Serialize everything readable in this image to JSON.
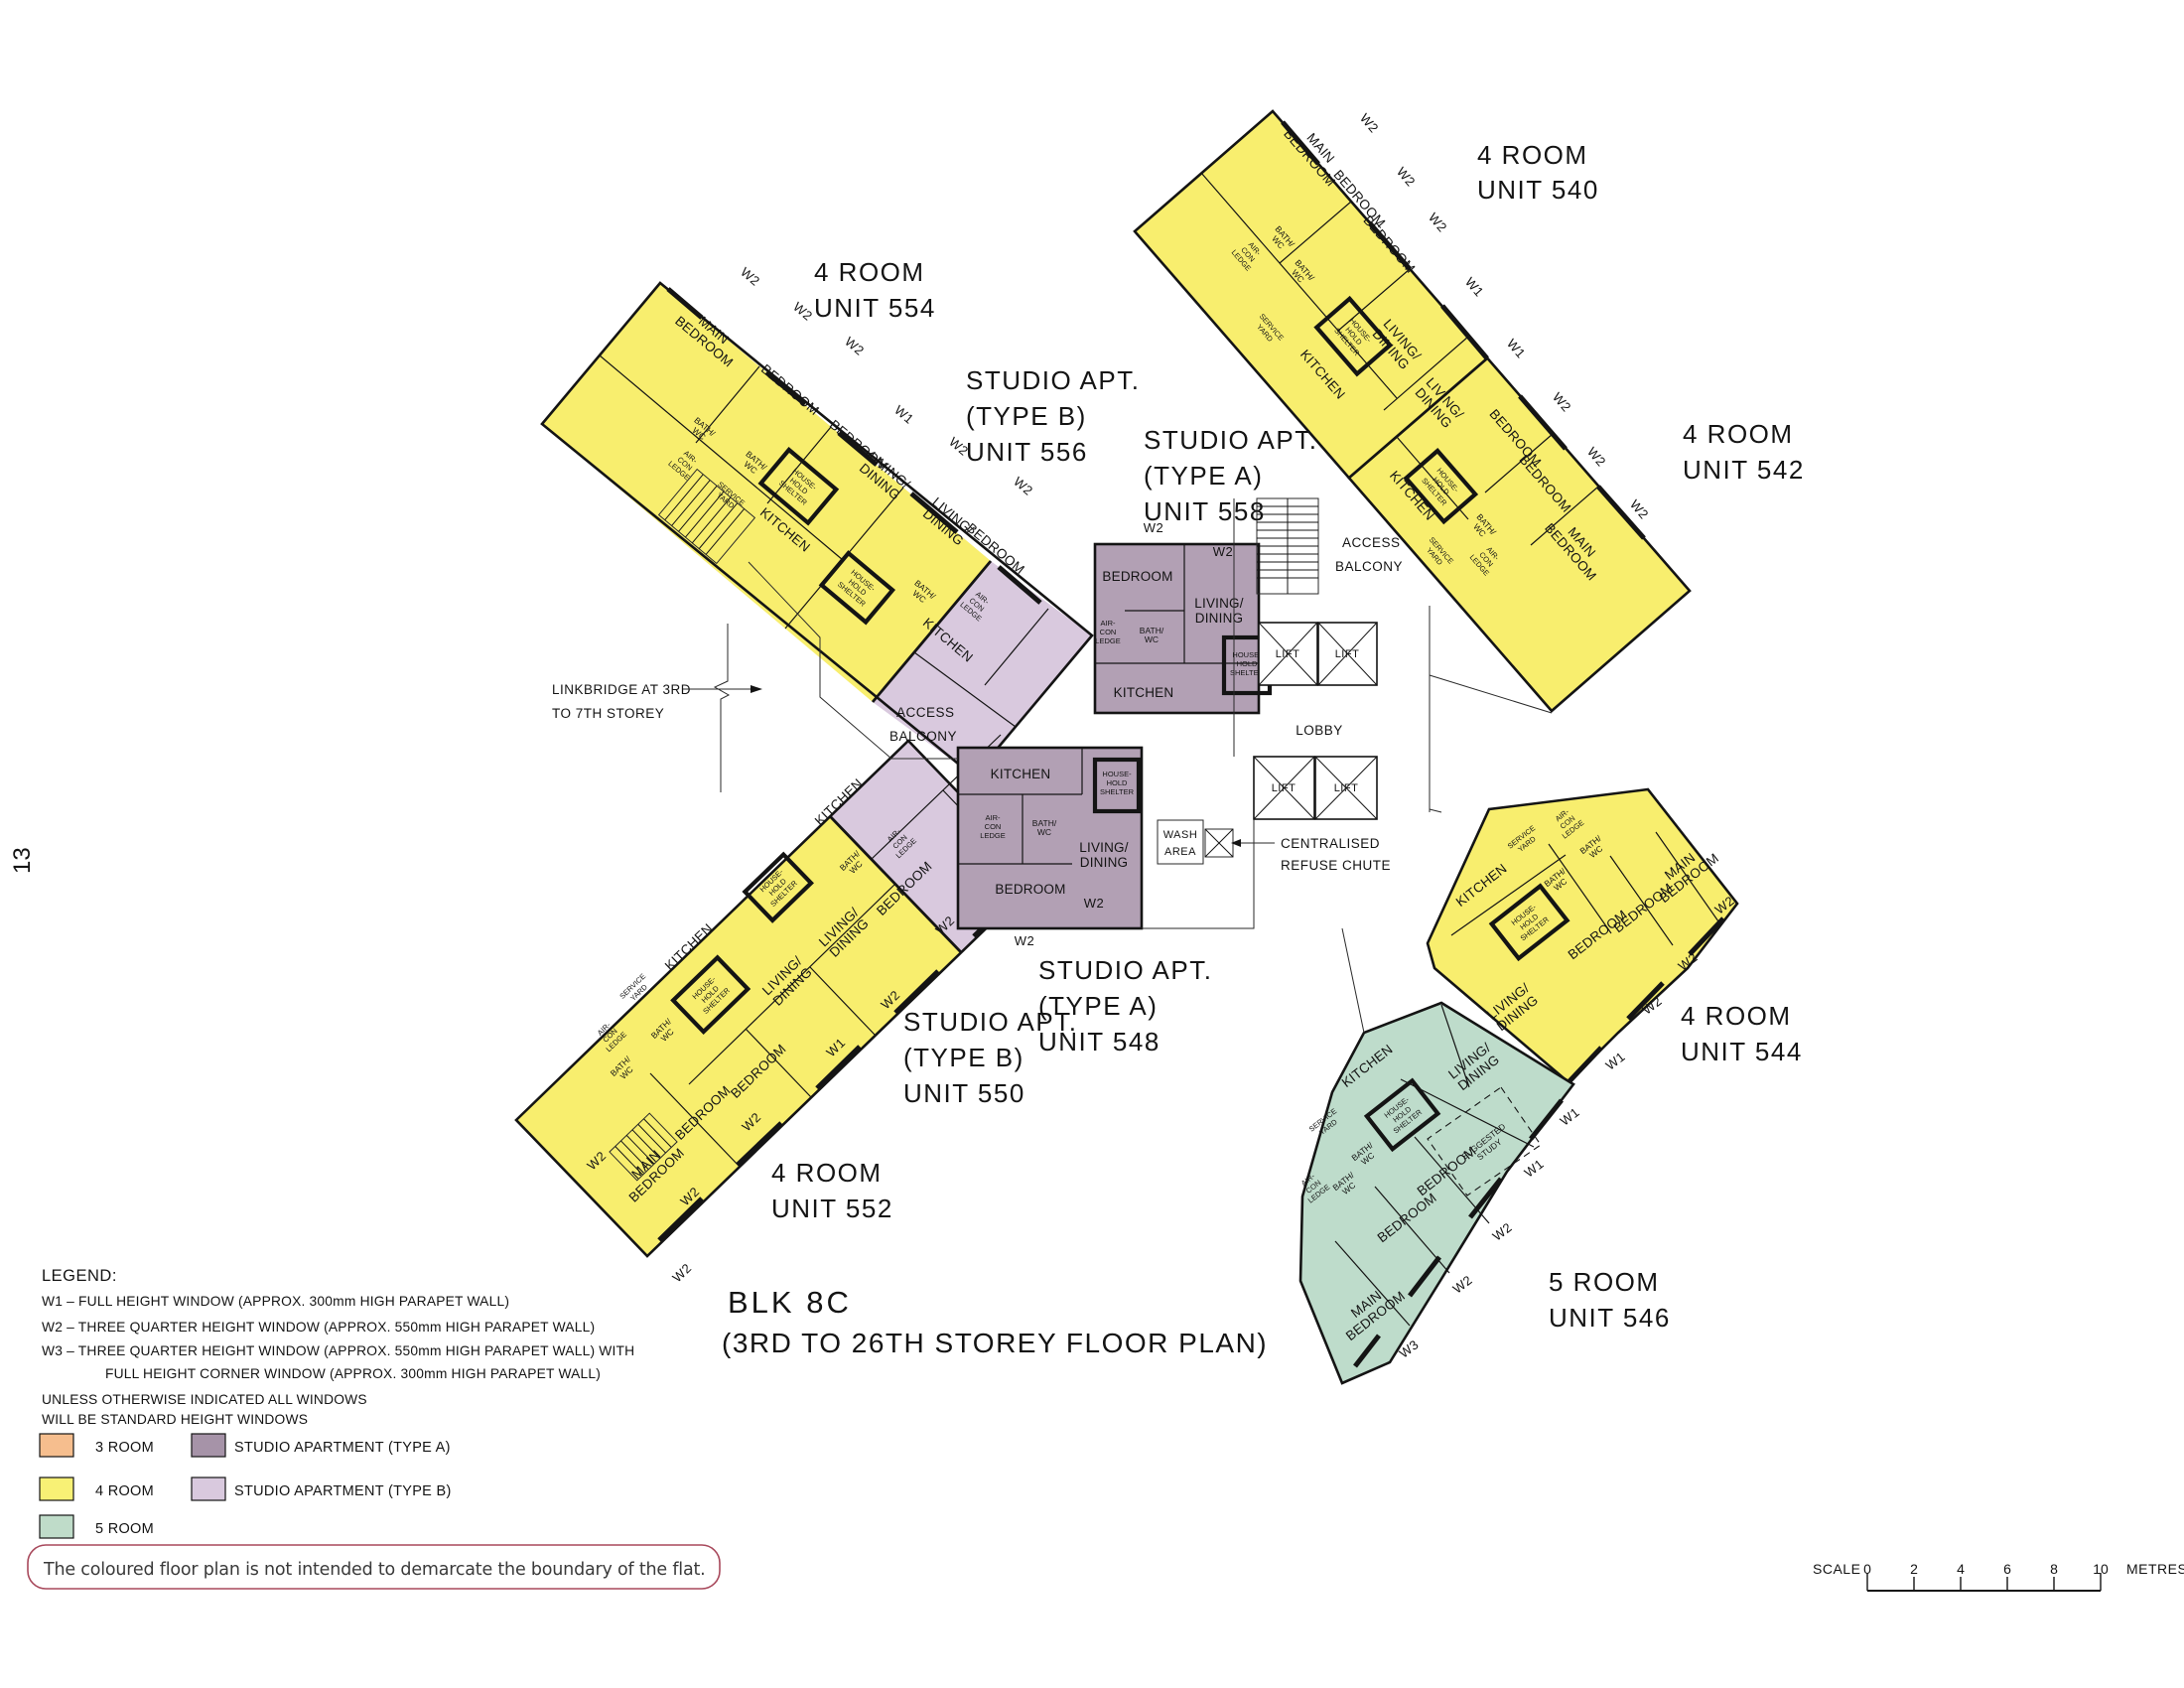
{
  "page": {
    "number": "13"
  },
  "title": {
    "l1": "BLK 8C",
    "l2": "(3RD TO 26TH STOREY FLOOR PLAN)"
  },
  "scale": {
    "label": "SCALE",
    "unit": "METRES",
    "t": [
      "0",
      "2",
      "4",
      "6",
      "8",
      "10"
    ]
  },
  "legend": {
    "heading": "LEGEND:",
    "w1": "W1 –  FULL HEIGHT WINDOW (APPROX. 300mm HIGH PARAPET WALL)",
    "w2": "W2 –  THREE QUARTER HEIGHT WINDOW (APPROX. 550mm HIGH PARAPET WALL)",
    "w3a": "W3 –  THREE QUARTER HEIGHT WINDOW (APPROX. 550mm HIGH PARAPET WALL) WITH",
    "w3b": "FULL HEIGHT CORNER WINDOW (APPROX. 300mm HIGH PARAPET WALL)",
    "note1": "UNLESS OTHERWISE INDICATED ALL WINDOWS",
    "note2": "WILL BE STANDARD HEIGHT WINDOWS",
    "swatches": [
      {
        "label": "3 ROOM",
        "color": "#F6BE8E"
      },
      {
        "label": "4 ROOM",
        "color": "#F8F175"
      },
      {
        "label": "5 ROOM",
        "color": "#BFDCC9"
      },
      {
        "label": "STUDIO APARTMENT (TYPE A)",
        "color": "#A693A8"
      },
      {
        "label": "STUDIO APARTMENT (TYPE B)",
        "color": "#D9C9DE"
      }
    ],
    "disclaimer": "The coloured floor plan is not intended to demarcate the boundary of the flat."
  },
  "colors": {
    "wall": "#141414",
    "room4": "#F8EE6E",
    "room5": "#BEDCCB",
    "studioA": "#B2A0B4",
    "studioB": "#D9C9DE",
    "noteBorder": "#A8495C"
  },
  "win": {
    "w1": "W1",
    "w2": "W2",
    "w3": "W3"
  },
  "rooms": {
    "main1": "MAIN",
    "main2": "BEDROOM",
    "bedroom": "BEDROOM",
    "kitchen": "KITCHEN",
    "living1": "LIVING/",
    "living2": "DINING",
    "bath1": "BATH/",
    "bath2": "WC",
    "hhs1": "HOUSE-",
    "hhs2": "HOLD",
    "hhs3": "SHELTER",
    "service1": "SERVICE",
    "service2": "YARD",
    "aircon1": "AIR-",
    "aircon2": "CON",
    "aircon3": "LEDGE",
    "study1": "SUGGESTED",
    "study2": "STUDY"
  },
  "core": {
    "lift": "LIFT",
    "lobby": "LOBBY",
    "wash1": "WASH",
    "wash2": "AREA",
    "refuse1": "CENTRALISED",
    "refuse2": "REFUSE CHUTE",
    "access1": "ACCESS",
    "access2": "BALCONY",
    "link1": "LINKBRIDGE AT 3RD",
    "link2": "TO 7TH STOREY"
  },
  "units": {
    "540": {
      "l1": "4 ROOM",
      "l2": "UNIT 540"
    },
    "542": {
      "l1": "4 ROOM",
      "l2": "UNIT 542"
    },
    "544": {
      "l1": "4 ROOM",
      "l2": "UNIT 544"
    },
    "546": {
      "l1": "5 ROOM",
      "l2": "UNIT 546"
    },
    "548": {
      "l1": "STUDIO APT.",
      "l2": "(TYPE A)",
      "l3": "UNIT 548"
    },
    "550": {
      "l1": "STUDIO APT.",
      "l2": "(TYPE B)",
      "l3": "UNIT 550"
    },
    "552": {
      "l1": "4 ROOM",
      "l2": "UNIT 552"
    },
    "554": {
      "l1": "4 ROOM",
      "l2": "UNIT 554"
    },
    "556": {
      "l1": "STUDIO APT.",
      "l2": "(TYPE B)",
      "l3": "UNIT 556"
    },
    "558": {
      "l1": "STUDIO APT.",
      "l2": "(TYPE A)",
      "l3": "UNIT 558"
    }
  }
}
